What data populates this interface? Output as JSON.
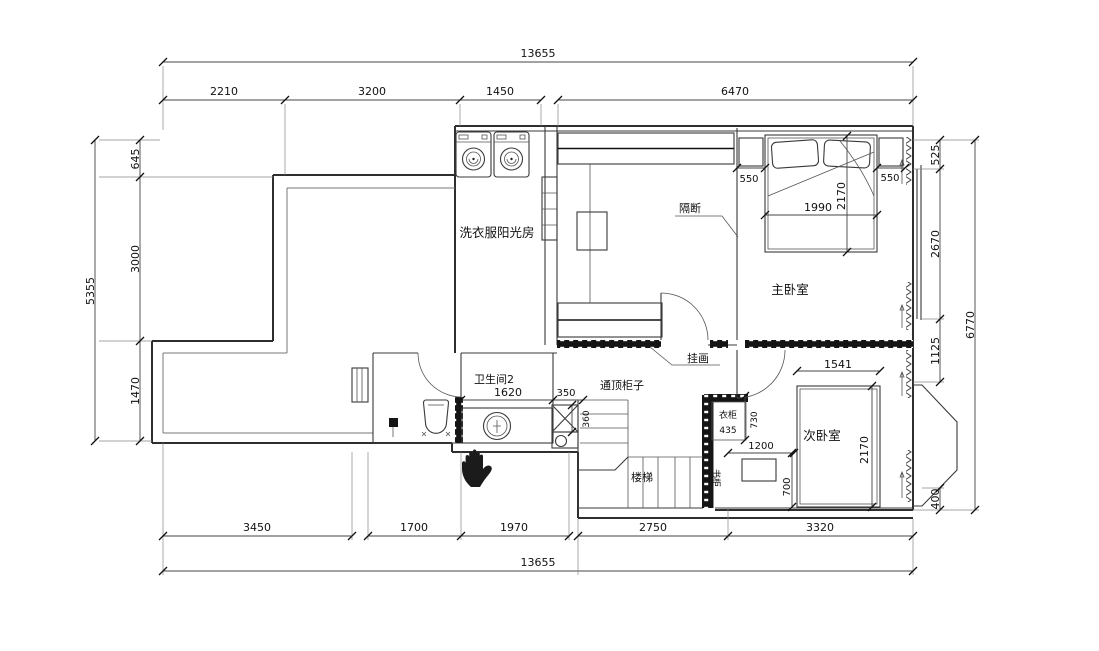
{
  "drawing": {
    "type": "floor-plan",
    "colors": {
      "ink": "#2e2e2e",
      "paper": "#ffffff",
      "dark_fill": "#151515"
    },
    "rooms": {
      "laundry_sunroom": "洗衣服阳光房",
      "master_bedroom": "主卧室",
      "secondary_bedroom": "次卧室",
      "bathroom2": "卫生间2",
      "stairs": "楼梯",
      "bookcase": "书柜",
      "wardrobe": "衣柜",
      "partition": "隔断",
      "hanging_picture": "挂画",
      "full_height_cabinet": "通顶柜子"
    },
    "dims": {
      "top_total": "13655",
      "top": [
        "2210",
        "3200",
        "1450",
        "6470"
      ],
      "left_total": "5355",
      "left": [
        "645",
        "3000",
        "1470"
      ],
      "right_total": "6770",
      "right": [
        "525",
        "2670",
        "1125",
        "400"
      ],
      "bottom_total": "13655",
      "bottom": [
        "3450",
        "1700",
        "1970",
        "2750",
        "3320"
      ],
      "master_bed_width": "1990",
      "master_bed_depth": "2170",
      "nightstand_left": "550",
      "nightstand_right": "550",
      "bath_vanity_width": "1620",
      "shaft_offset": "350",
      "shaft_width": "360",
      "wardrobe_width": "435",
      "wardrobe_depth": "730",
      "desk_zone_width": "1200",
      "desk_depth": "700",
      "secondary_bed_width": "1541",
      "secondary_bed_depth": "2170"
    }
  }
}
